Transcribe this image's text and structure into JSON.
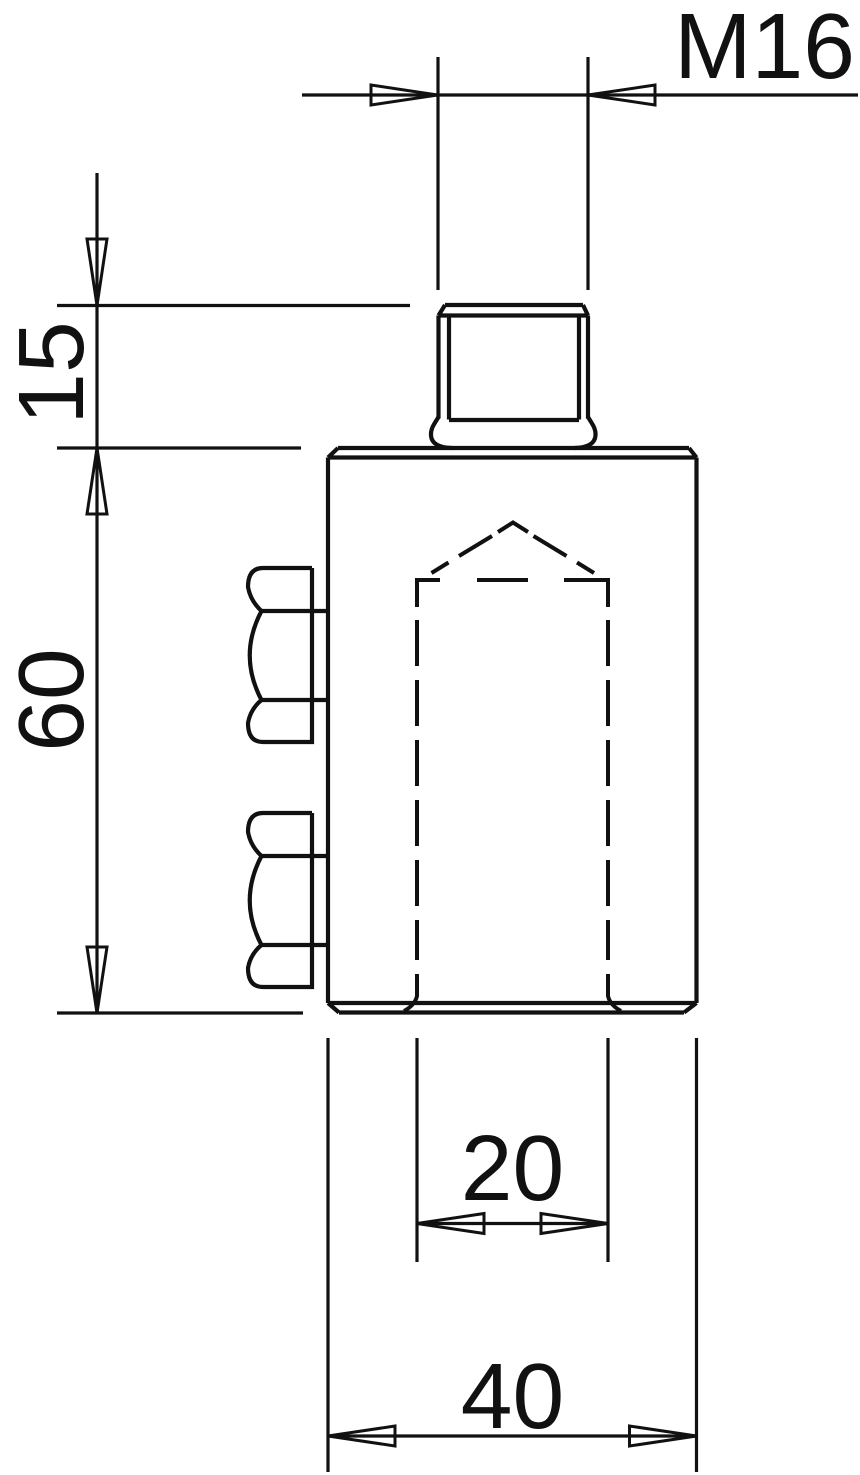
{
  "drawing": {
    "kind": "engineering dimension drawing",
    "background_color": "#ffffff",
    "line_color": "#111111",
    "labels": {
      "thread": "M16",
      "stud_length": "15",
      "body_height": "60",
      "bore_width": "20",
      "body_width": "40"
    }
  }
}
